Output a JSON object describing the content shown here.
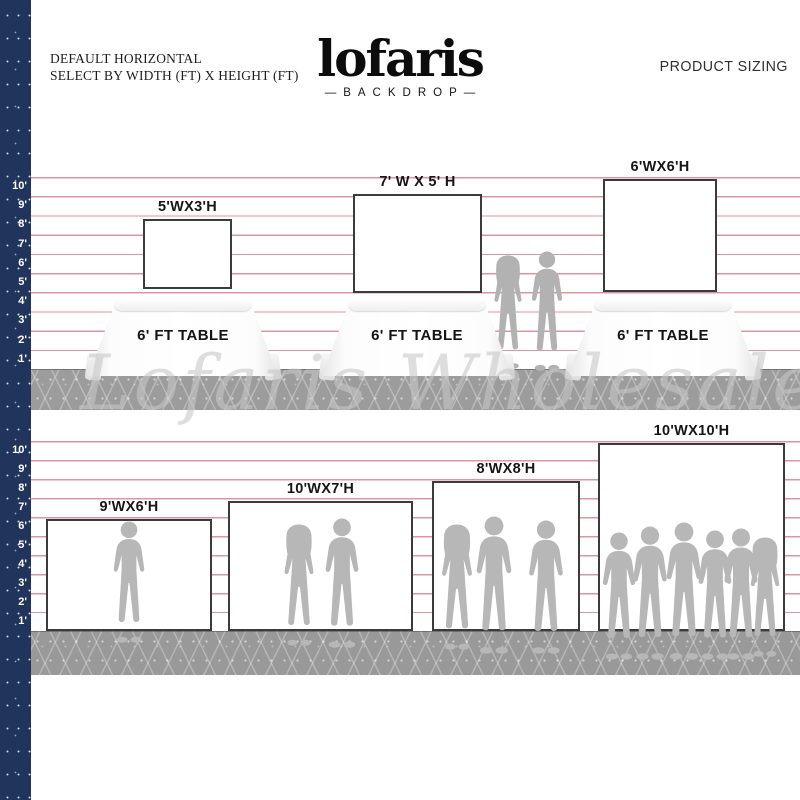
{
  "header": {
    "title_line1": "DEFAULT HORIZONTAL",
    "title_line2": "SELECT BY WIDTH (FT) X HEIGHT (FT)",
    "product_sizing": "PRODUCT SIZING"
  },
  "logo": {
    "brand": "lofaris",
    "sub": "—BACKDROP—"
  },
  "watermark": "Lofaris Wholesale",
  "ruler": {
    "labels": [
      "10'",
      "9'",
      "8'",
      "7'",
      "6'",
      "5'",
      "4'",
      "3'",
      "2'",
      "1'"
    ]
  },
  "scenes": {
    "tabletop_row": {
      "table_label": "6' FT TABLE",
      "backdrops": [
        {
          "label": "5'WX3'H"
        },
        {
          "label": "7' W X 5' H"
        },
        {
          "label": "6'WX6'H"
        }
      ]
    },
    "floor_row": {
      "backdrops": [
        {
          "label": "9'WX6'H"
        },
        {
          "label": "10'WX7'H"
        },
        {
          "label": "8'WX8'H"
        },
        {
          "label": "10'WX10'H"
        }
      ]
    }
  },
  "colors": {
    "navy_strip": "#20345c",
    "grid_line": "#dc96a1",
    "floor_gray": "#9c9c9c",
    "silhouette_gray": "#b5b5b5",
    "backdrop_border": "#3b3b3b"
  }
}
